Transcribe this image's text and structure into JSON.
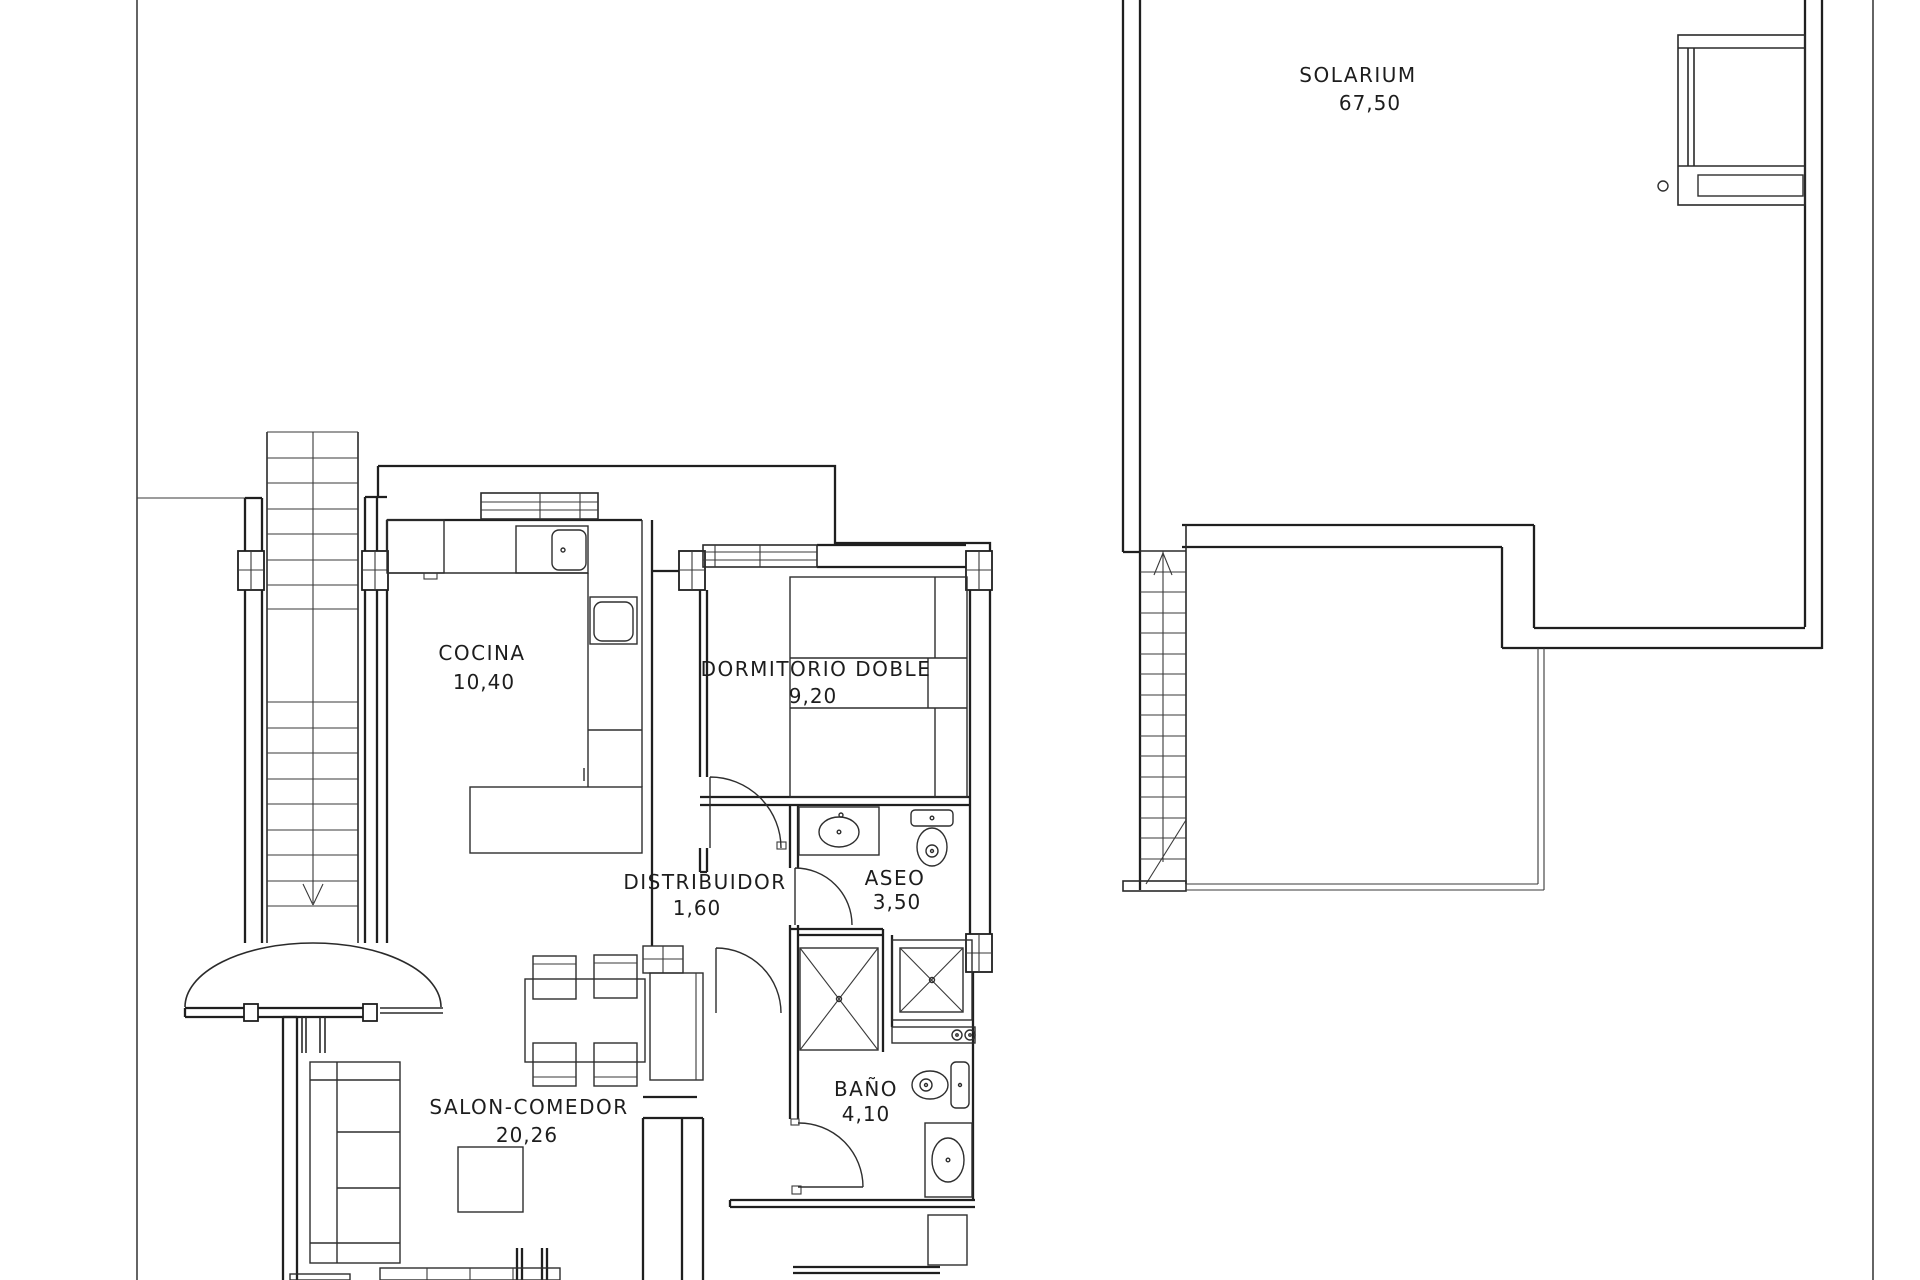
{
  "drawing": {
    "background": "#ffffff",
    "line_color": "#1f1f1f",
    "type": "floor-plan"
  },
  "rooms": [
    {
      "id": "solarium",
      "name": "SOLARIUM",
      "area": "67,50"
    },
    {
      "id": "cocina",
      "name": "COCINA",
      "area": "10,40"
    },
    {
      "id": "dormitorio",
      "name": "DORMITORIO DOBLE",
      "area": "9,20"
    },
    {
      "id": "distribuidor",
      "name": "DISTRIBUIDOR",
      "area": "1,60"
    },
    {
      "id": "aseo",
      "name": "ASEO",
      "area": "3,50"
    },
    {
      "id": "salon",
      "name": "SALON-COMEDOR",
      "area": "20,26"
    },
    {
      "id": "bano",
      "name": "BAÑO",
      "area": "4,10"
    }
  ]
}
